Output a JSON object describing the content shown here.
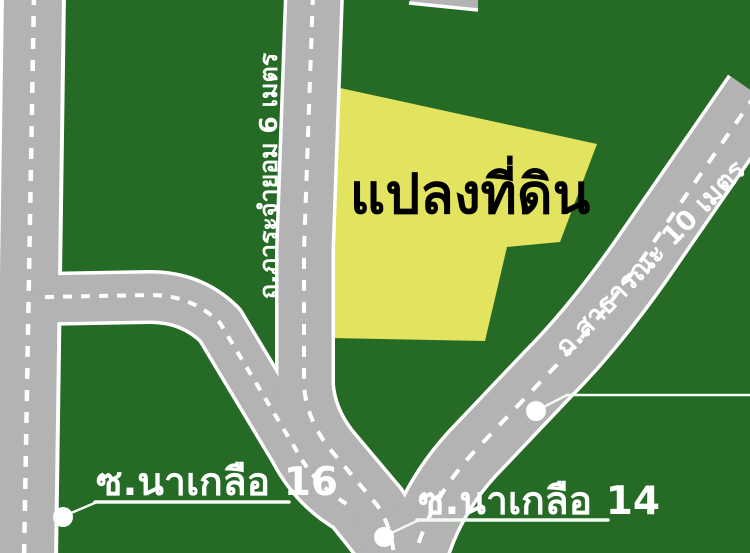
{
  "map": {
    "background_color": "#256a25",
    "road_fill_color": "#b3b3b3",
    "road_edge_color": "#ffffff",
    "road_dash_color": "#ffffff",
    "callout_color": "#f2faf2",
    "callout_dot_color": "#ffffff",
    "land_plot": {
      "label": "แปลงที่ดิน",
      "fill_color": "#e2e45f",
      "label_color": "#000000"
    },
    "roads": {
      "easement_road": {
        "label": "ถ.ภาระจำยอม 6 เมตร"
      },
      "public_road": {
        "label": "ถ.สาธารณะ 10 เมตร"
      },
      "soi_naklua_16": {
        "label": "ซ.นาเกลือ 16"
      },
      "soi_naklua_14": {
        "label": "ซ.นาเกลือ 14"
      }
    }
  }
}
